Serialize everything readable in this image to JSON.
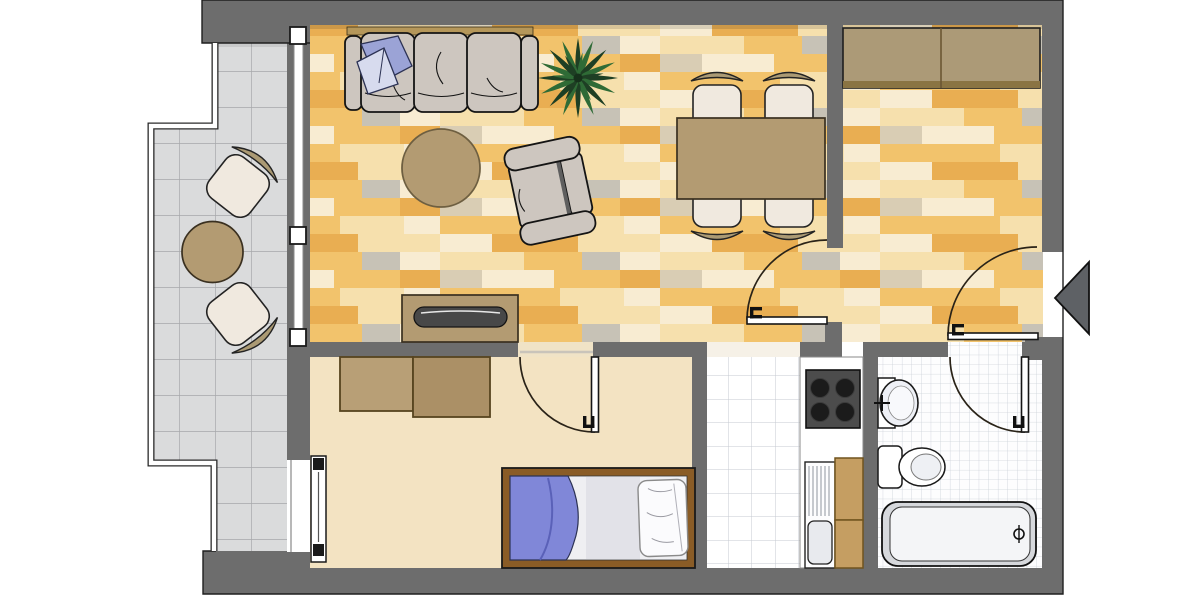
{
  "colors": {
    "wall": "#6d6d6d",
    "outline": "#1f1f1f",
    "arrow": "#5e6165",
    "doorArc": "#2a2318",
    "balconyTile": "#dadbdc",
    "balconyTileLine": "#a6a8ab",
    "kitchenTile": "#ffffff",
    "kitchenTileLine": "#c6cad0",
    "bathTile": "#fdfdfe",
    "bathTileLine": "#ccd1d9",
    "bedroomFloor": "#f3e3c2",
    "wood0": "#f3cf8e",
    "wood1": "#f2c36c",
    "wood2": "#f6e0ad",
    "wood3": "#e9ae52",
    "wood4": "#f8ecd2",
    "wood5": "#d9cdb4",
    "wood6": "#c7c2b6",
    "tan": "#b39b72",
    "tanBack": "#ab9a74",
    "chairSeat": "#f0e9df",
    "sofa": "#cdc6bf",
    "sofaLine": "#141414",
    "pillowLight": "#d7dbee",
    "pillowDark": "#9ba3d6",
    "plantDark": "#1e3f24",
    "plantMid": "#2f6b36",
    "shelf": "#b5975a",
    "wardrobeHall": "#ac9a77",
    "wardrobeHallEdge": "#8a7443",
    "wardrobeLeft": "#b89f76",
    "wardrobeRight": "#ab9066",
    "wardrobeEdge": "#57441f",
    "sideboardScreen": "#484848",
    "bedFrame": "#8a5c26",
    "bedInner": "#efeff2",
    "blanket": "#8087d8",
    "blanketFold": "#5a61b8",
    "stove": "#4c4c4c",
    "burner": "#1b1b1b",
    "cabinet": "#c59e62",
    "cabinetEdge": "#70541e",
    "fixture": "#ffffff",
    "counterEdge": "#8a8a8a",
    "rugEdge": "#6e5f41"
  },
  "plan": {
    "type": "apartment-floor-plan",
    "rooms": [
      {
        "id": "balcony",
        "floor": "gray-tiles",
        "furniture": [
          "balcony-chair-top",
          "balcony-chair-bottom",
          "balcony-round-table"
        ]
      },
      {
        "id": "living-dining-room",
        "floor": "wood-planks",
        "furniture": [
          "wall-shelf",
          "sofa",
          "sofa-pillow",
          "round-rug",
          "armchair",
          "potted-plant",
          "sideboard",
          "dining-table",
          "dining-chair-1",
          "dining-chair-2",
          "dining-chair-3",
          "dining-chair-4"
        ]
      },
      {
        "id": "hallway",
        "floor": "wood-planks",
        "furniture": [
          "hall-wardrobe"
        ]
      },
      {
        "id": "bedroom",
        "floor": "beige",
        "furniture": [
          "bedroom-wardrobe-left",
          "bedroom-wardrobe-right",
          "single-bed",
          "bedroom-window-unit"
        ]
      },
      {
        "id": "kitchen",
        "floor": "white-tiles",
        "furniture": [
          "kitchen-counter",
          "stove",
          "kitchen-sink",
          "kitchen-cabinets"
        ]
      },
      {
        "id": "bathroom",
        "floor": "fine-white-tiles",
        "furniture": [
          "wash-basin",
          "toilet",
          "bathtub"
        ]
      }
    ],
    "doors": [
      "living-to-hall-door",
      "bedroom-door",
      "bathroom-door",
      "entrance-door"
    ],
    "windows": [
      "balcony-sliding-door",
      "bedroom-window"
    ],
    "entrance_marker": "left-pointing-arrow"
  }
}
